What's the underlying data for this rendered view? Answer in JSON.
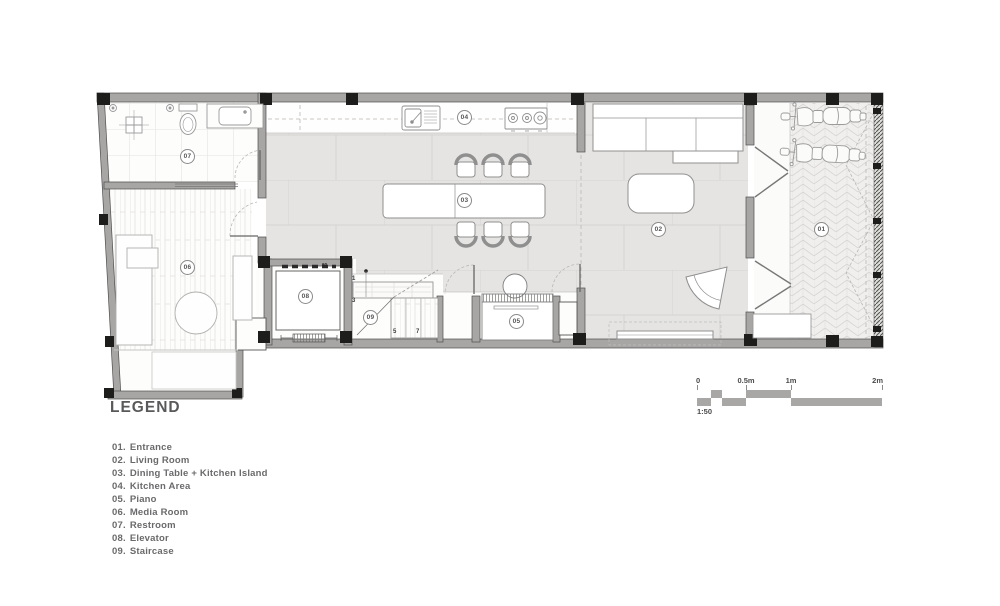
{
  "plan": {
    "room_badges": [
      "01",
      "02",
      "03",
      "04",
      "05",
      "06",
      "07",
      "08",
      "09"
    ],
    "stair_numbers": [
      "1",
      "3",
      "5",
      "7"
    ],
    "elevator_capacity": "60"
  },
  "legend": {
    "title": "LEGEND",
    "items": [
      {
        "num": "01.",
        "name": "Entrance"
      },
      {
        "num": "02.",
        "name": "Living Room"
      },
      {
        "num": "03.",
        "name": "Dining Table + Kitchen Island"
      },
      {
        "num": "04.",
        "name": "Kitchen Area"
      },
      {
        "num": "05.",
        "name": "Piano"
      },
      {
        "num": "06.",
        "name": "Media Room"
      },
      {
        "num": "07.",
        "name": "Restroom"
      },
      {
        "num": "08.",
        "name": "Elevator"
      },
      {
        "num": "09.",
        "name": "Staircase"
      }
    ]
  },
  "scale_bar": {
    "ticks": [
      "0",
      "0.5m",
      "1m",
      "2m"
    ],
    "ratio": "1:50"
  },
  "colors": {
    "wall": "#a8a6a4",
    "column": "#1d1d1b",
    "tile_floor": "#e6e4e2",
    "tile_line": "#d5d3d1",
    "furniture_line": "#8f8f8f",
    "text": "#6a6a6c"
  }
}
